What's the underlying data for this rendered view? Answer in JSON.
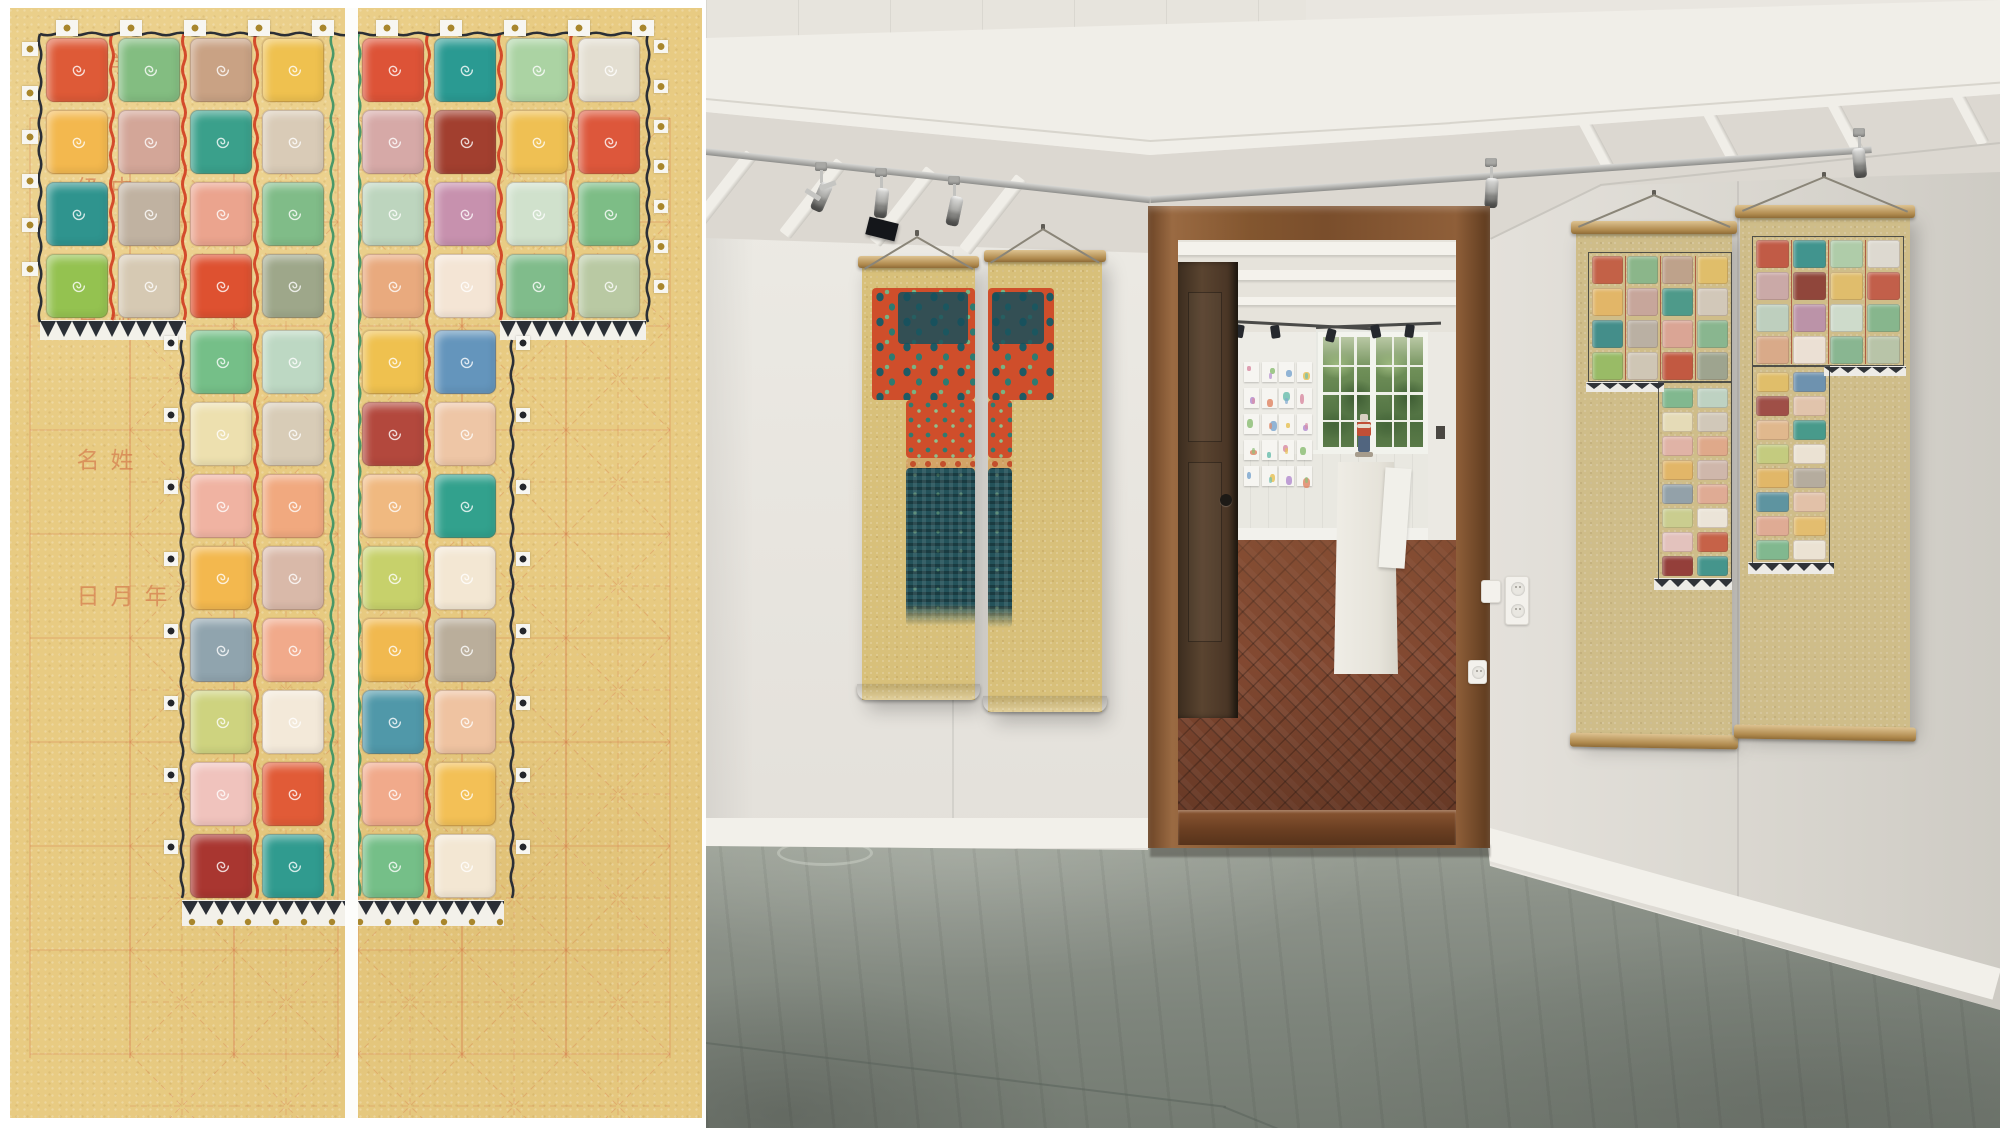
{
  "artwork": {
    "description": "crayon patchwork kimono/T-shape on tan calligraphy practice paper, two vertical panels",
    "margin_labels": [
      {
        "text": "学校",
        "y": 52
      },
      {
        "text": "中级",
        "y": 176
      },
      {
        "text": "班号",
        "y": 312
      },
      {
        "text": "姓名",
        "y": 448
      },
      {
        "text": "年月日",
        "y": 584
      }
    ],
    "paper_color": "#e8cb82",
    "quilt": {
      "band_rows": [
        [
          "#de5a37",
          "#83bd81",
          "#c9a284",
          "#efc14f",
          "#dd5337",
          "#2a9a92",
          "#abd3a3",
          "#e3ded1"
        ],
        [
          "#f3b84e",
          "#d3a698",
          "#3aa08b",
          "#d9cbb7",
          "#d6a9a7",
          "#a23f2f",
          "#efc053",
          "#dd573b"
        ],
        [
          "#2f948e",
          "#c0b2a1",
          "#eba48e",
          "#80bc88",
          "#bdd5be",
          "#c791ae",
          "#d0e1cc",
          "#7dbd86"
        ],
        [
          "#94c250",
          "#d6c9b3",
          "#de5130",
          "#9ea78a",
          "#e9aa7e",
          "#f4e5d5",
          "#80bc8b",
          "#b9c9a3"
        ]
      ],
      "stem_rows": [
        [
          "#75bf88",
          "#bdd8c3",
          "#efc14f",
          "#6495bc"
        ],
        [
          "#ede0af",
          "#d8ccb7",
          "#b3483d",
          "#eec6a6"
        ],
        [
          "#f0b3a2",
          "#f1a97f",
          "#f0b980",
          "#32a18d"
        ],
        [
          "#f3b84e",
          "#d9b9a9",
          "#c7d16b",
          "#f3e7d3"
        ],
        [
          "#90a4ae",
          "#f1aa8b",
          "#f1b94f",
          "#baae9b"
        ],
        [
          "#ced37f",
          "#f3e9d9",
          "#5098a9",
          "#efc3a1"
        ],
        [
          "#f0c3bd",
          "#e15b37",
          "#f1aa8b",
          "#f3c056"
        ],
        [
          "#a93630",
          "#309b8f",
          "#75bf88",
          "#f3e7d3"
        ]
      ],
      "stem_col_range": [
        2,
        5
      ],
      "separator_red": "#d03c20",
      "separator_green": "#2e8e62",
      "outline_black": "#2b2f36",
      "gold_dot": "#a8862c"
    }
  },
  "photo": {
    "description": "gallery room: teal/orange two-panel scroll print on left wall, open wooden doorway to back room with window, pinned sketches, pedestal sculpture, terracotta floor; two colorful quilt scrolls on right wall; concrete floor",
    "left_scroll_print": {
      "orange": "#cf4e2b",
      "teal_dark": "#1e5a64",
      "teal_mid": "#2f7a70",
      "green": "#79b383",
      "dense": "#24525a"
    },
    "papers_marks": [
      "#d98fa6",
      "#8fbf79",
      "#7fa8d0",
      "#e8c35a",
      "#b58fd0",
      "#e08a6a",
      "#6fbfb0"
    ],
    "figurine": {
      "head": "#d9d0c2",
      "torso": "#c14f36",
      "band": "#e4dccb",
      "legs": "#51657f",
      "base": "#a69c8c"
    },
    "counts": {
      "left_track_lights": 3,
      "right_track_lights": 2,
      "backroom_track_heads": 6,
      "paper_sheet_cols": 4,
      "paper_sheet_rows": 5,
      "window_pane_cols": 3,
      "window_pane_rows": 4
    }
  },
  "palette": {
    "art_paper": "#e8cb82",
    "grid_red": "#d4764a",
    "wall": "#e9e6e0",
    "beam": "#f0eee8",
    "joist_bg": "#dcd8d1",
    "baseboard": "#f2f0ea",
    "floor_mid": "#868d83",
    "wood_frame": "#8a5a35",
    "door_leaf": "#4a3726",
    "terracotta": "#8c4f36",
    "scroll_paper": "#d8c07a",
    "p_orange": "#cf4e2b",
    "p_teal": "#1e5a64",
    "p_tealmid": "#2f7a70",
    "p_green": "#79b383",
    "p_dense": "#24525a",
    "chrome": "#b9bcbd",
    "foliage": "#5f824c"
  }
}
